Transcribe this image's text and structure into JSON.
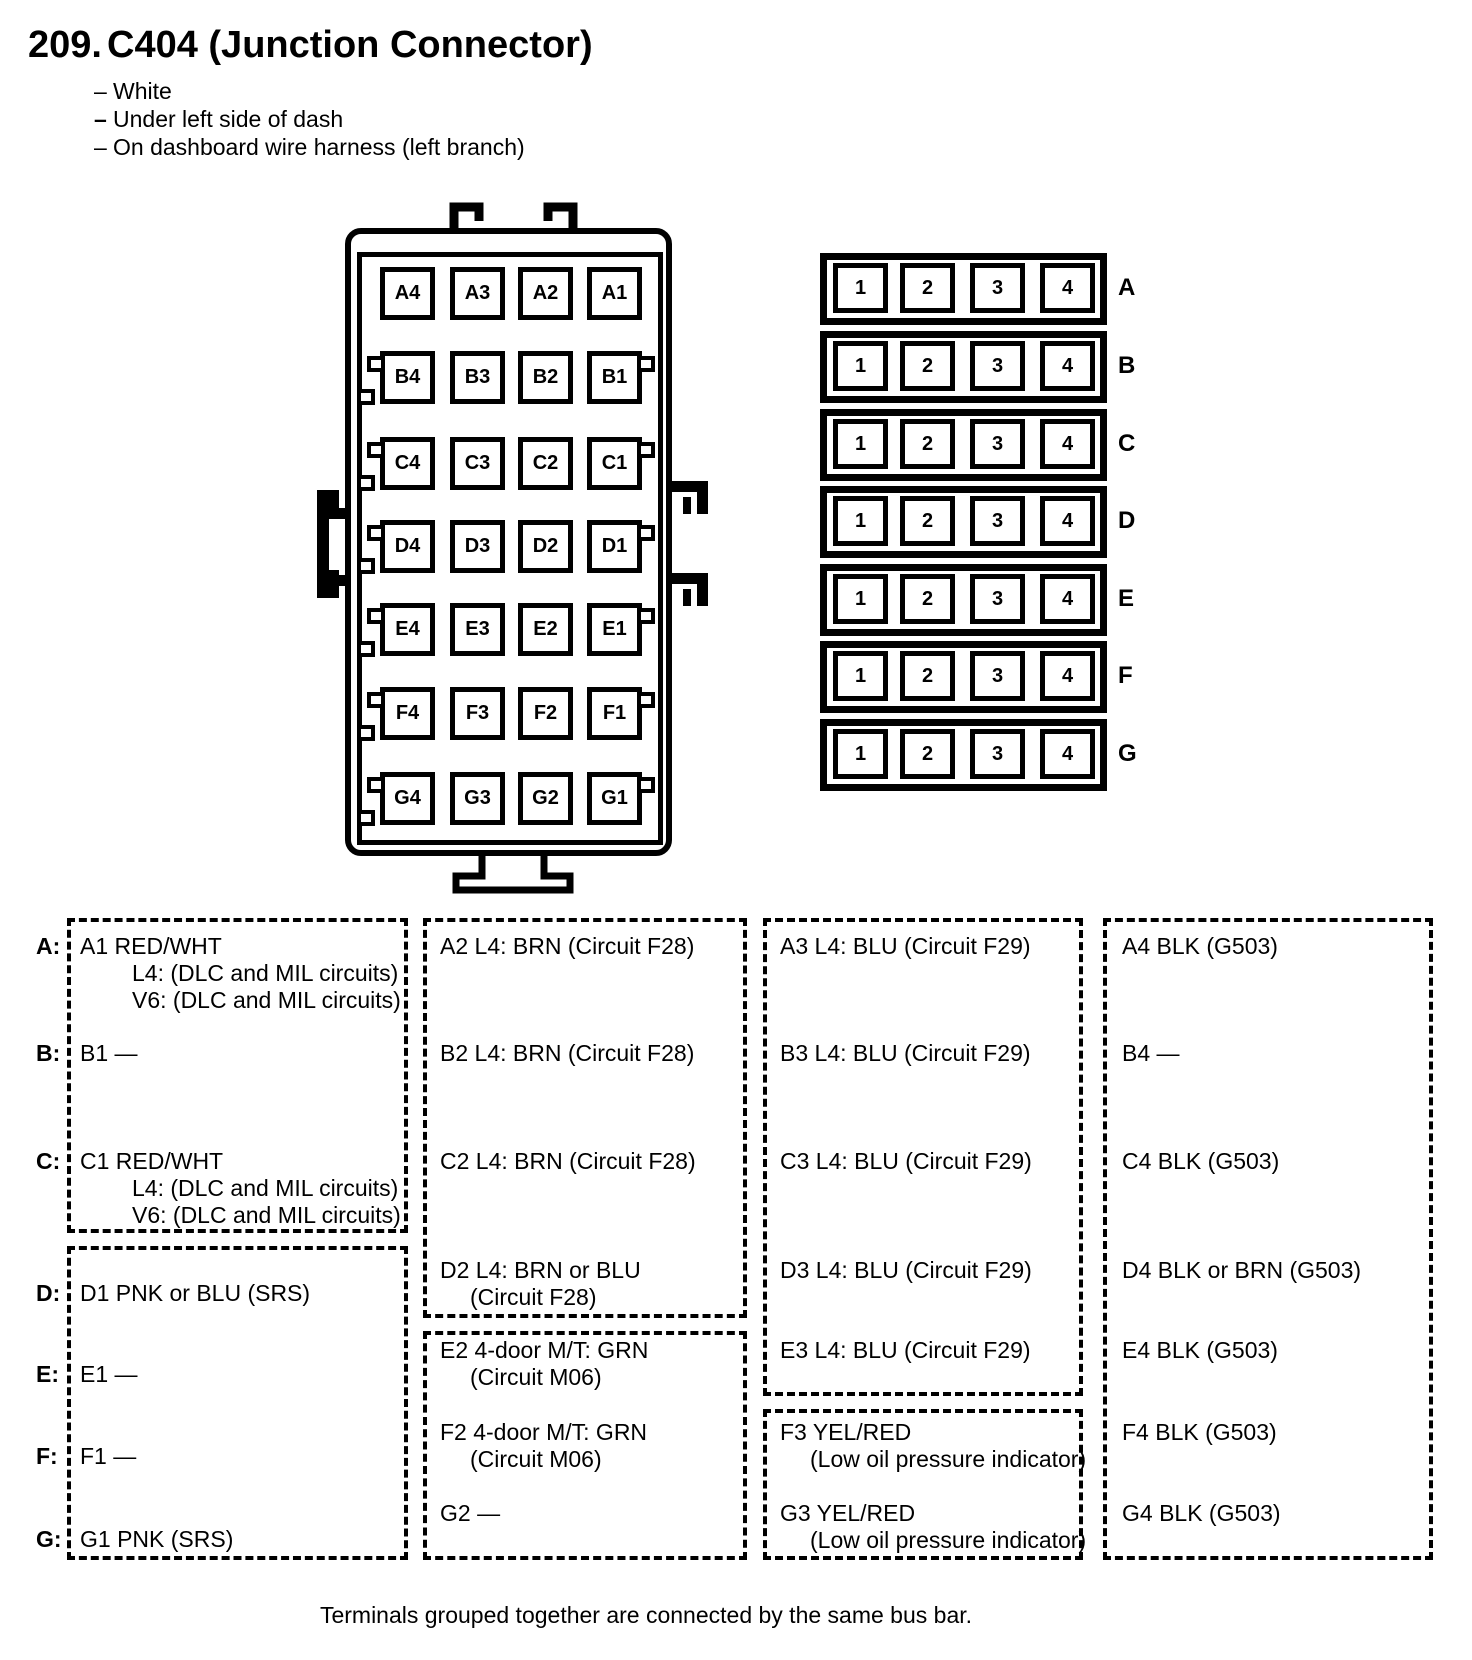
{
  "header": {
    "number": "209.",
    "title": "C404 (Junction Connector)",
    "note_dash": "–",
    "notes": [
      "White",
      "Under left side of dash",
      "On dashboard wire harness (left branch)"
    ]
  },
  "connector_grid": {
    "rows": [
      {
        "letter": "A",
        "cells": [
          "A4",
          "A3",
          "A2",
          "A1"
        ]
      },
      {
        "letter": "B",
        "cells": [
          "B4",
          "B3",
          "B2",
          "B1"
        ]
      },
      {
        "letter": "C",
        "cells": [
          "C4",
          "C3",
          "C2",
          "C1"
        ]
      },
      {
        "letter": "D",
        "cells": [
          "D4",
          "D3",
          "D2",
          "D1"
        ]
      },
      {
        "letter": "E",
        "cells": [
          "E4",
          "E3",
          "E2",
          "E1"
        ]
      },
      {
        "letter": "F",
        "cells": [
          "F4",
          "F3",
          "F2",
          "F1"
        ]
      },
      {
        "letter": "G",
        "cells": [
          "G4",
          "G3",
          "G2",
          "G1"
        ]
      }
    ]
  },
  "bus_bar_grid": {
    "rows": [
      {
        "letter": "A",
        "cells": [
          "1",
          "2",
          "3",
          "4"
        ]
      },
      {
        "letter": "B",
        "cells": [
          "1",
          "2",
          "3",
          "4"
        ]
      },
      {
        "letter": "C",
        "cells": [
          "1",
          "2",
          "3",
          "4"
        ]
      },
      {
        "letter": "D",
        "cells": [
          "1",
          "2",
          "3",
          "4"
        ]
      },
      {
        "letter": "E",
        "cells": [
          "1",
          "2",
          "3",
          "4"
        ]
      },
      {
        "letter": "F",
        "cells": [
          "1",
          "2",
          "3",
          "4"
        ]
      },
      {
        "letter": "G",
        "cells": [
          "1",
          "2",
          "3",
          "4"
        ]
      }
    ]
  },
  "pin_table": {
    "row_labels": [
      "A:",
      "B:",
      "C:",
      "D:",
      "E:",
      "F:",
      "G:"
    ],
    "pins": {
      "A1": {
        "lines": [
          "A1 RED/WHT",
          "L4: (DLC and MIL circuits)",
          "V6: (DLC and MIL circuits)"
        ]
      },
      "A2": {
        "lines": [
          "A2 L4: BRN (Circuit F28)"
        ]
      },
      "A3": {
        "lines": [
          "A3 L4: BLU (Circuit F29)"
        ]
      },
      "A4": {
        "lines": [
          "A4 BLK (G503)"
        ]
      },
      "B1": {
        "lines": [
          "B1 —"
        ]
      },
      "B2": {
        "lines": [
          "B2 L4: BRN (Circuit F28)"
        ]
      },
      "B3": {
        "lines": [
          "B3 L4: BLU (Circuit F29)"
        ]
      },
      "B4": {
        "lines": [
          "B4 —"
        ]
      },
      "C1": {
        "lines": [
          "C1 RED/WHT",
          "L4: (DLC and MIL circuits)",
          "V6: (DLC and MIL circuits)"
        ]
      },
      "C2": {
        "lines": [
          "C2 L4: BRN (Circuit F28)"
        ]
      },
      "C3": {
        "lines": [
          "C3 L4: BLU (Circuit F29)"
        ]
      },
      "C4": {
        "lines": [
          "C4 BLK (G503)"
        ]
      },
      "D1": {
        "lines": [
          "D1 PNK or BLU (SRS)"
        ]
      },
      "D2": {
        "lines": [
          "D2 L4: BRN or BLU",
          "(Circuit F28)"
        ]
      },
      "D3": {
        "lines": [
          "D3 L4: BLU (Circuit F29)"
        ]
      },
      "D4": {
        "lines": [
          "D4 BLK or BRN (G503)"
        ]
      },
      "E1": {
        "lines": [
          "E1 —"
        ]
      },
      "E2": {
        "lines": [
          "E2 4-door M/T: GRN",
          "(Circuit M06)"
        ]
      },
      "E3": {
        "lines": [
          "E3 L4: BLU (Circuit F29)"
        ]
      },
      "E4": {
        "lines": [
          "E4 BLK (G503)"
        ]
      },
      "F1": {
        "lines": [
          "F1 —"
        ]
      },
      "F2": {
        "lines": [
          "F2 4-door M/T: GRN",
          "(Circuit M06)"
        ]
      },
      "F3": {
        "lines": [
          "F3 YEL/RED",
          "(Low oil pressure indicator)"
        ]
      },
      "F4": {
        "lines": [
          "F4 BLK (G503)"
        ]
      },
      "G1": {
        "lines": [
          "G1 PNK (SRS)"
        ]
      },
      "G2": {
        "lines": [
          "G2 —"
        ]
      },
      "G3": {
        "lines": [
          "G3 YEL/RED",
          "(Low oil pressure indicator)"
        ]
      },
      "G4": {
        "lines": [
          "G4 BLK (G503)"
        ]
      }
    },
    "bus_groups": [
      {
        "column": 1,
        "pins": [
          "A1",
          "B1",
          "C1"
        ]
      },
      {
        "column": 1,
        "pins": [
          "D1",
          "E1",
          "F1",
          "G1"
        ]
      },
      {
        "column": 2,
        "pins": [
          "A2",
          "B2",
          "C2",
          "D2"
        ]
      },
      {
        "column": 2,
        "pins": [
          "E2",
          "F2",
          "G2"
        ]
      },
      {
        "column": 3,
        "pins": [
          "A3",
          "B3",
          "C3",
          "D3",
          "E3"
        ]
      },
      {
        "column": 3,
        "pins": [
          "F3",
          "G3"
        ]
      },
      {
        "column": 4,
        "pins": [
          "A4",
          "B4",
          "C4",
          "D4",
          "E4",
          "F4",
          "G4"
        ]
      }
    ]
  },
  "footnote": "Terminals grouped together are connected by the same bus bar."
}
